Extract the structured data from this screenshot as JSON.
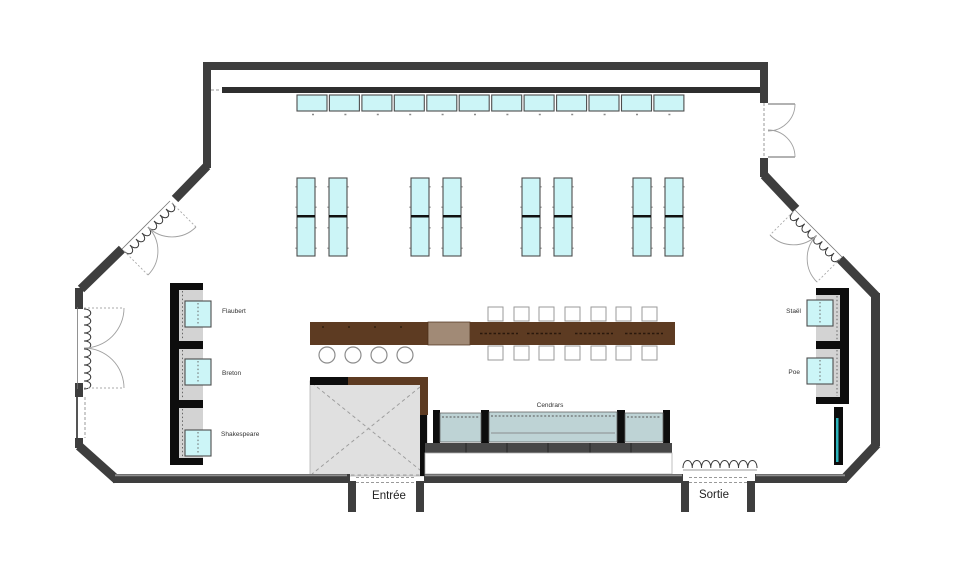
{
  "plan": {
    "labels": {
      "flaubert": "Flaubert",
      "breton": "Breton",
      "shakespeare": "Shakespeare",
      "stael": "Staël",
      "poe": "Poe",
      "cendrars": "Cendrars",
      "entree": "Entrée",
      "sortie": "Sortie"
    },
    "colors": {
      "floor": "#ffffff",
      "wall": "#3e3e3e",
      "wall_light": "#8f8f8f",
      "counter": "#2e2e2e",
      "table_cyan": "#ccf5f7",
      "table_border": "#4d4d4d",
      "booth_gray": "#d3d3d3",
      "booth_frame": "#0d0d0d",
      "bench_seat": "#bed3d5",
      "bench_base": "#474747",
      "bar_dark": "#5d3b22",
      "bar_light": "#a18a76",
      "cabinet_teal": "#2cb4bc",
      "service_gray": "#e0e0e0",
      "door_arc": "#a0a0a0",
      "label_text": "#333333"
    }
  }
}
